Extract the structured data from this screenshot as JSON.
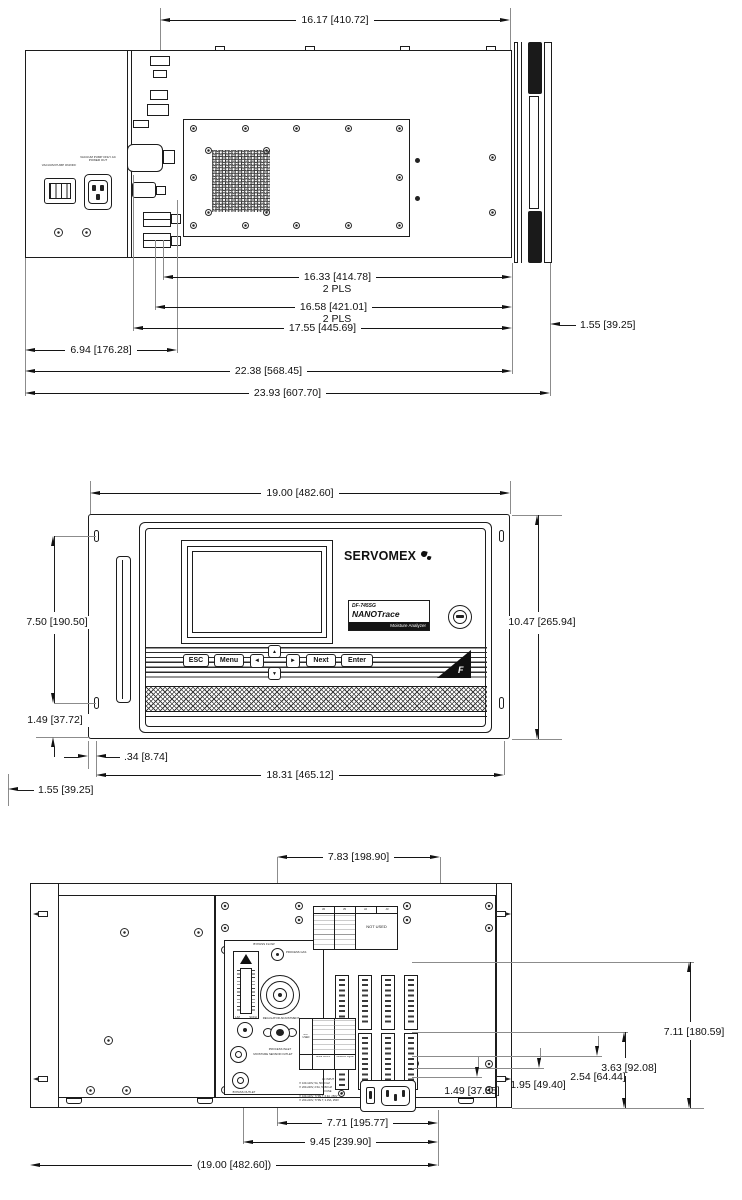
{
  "top_view": {
    "dims": {
      "overall": "16.17 [410.72]",
      "d1": "16.33 [414.78]",
      "d1_note": "2 PLS",
      "d2": "16.58 [421.01]",
      "d2_note": "2 PLS",
      "d3": "17.55 [445.69]",
      "d4": "6.94 [176.28]",
      "d5": "22.38 [568.45]",
      "d6": "23.93 [607.70]",
      "d7": "1.55 [39.25]"
    },
    "labels": {
      "switch": "VACUUM PUMP ON/OFF",
      "outlet": "VACUUM PUMP ONLY AC POWER OUT"
    }
  },
  "front_view": {
    "dims": {
      "width": "19.00 [482.60]",
      "slots": "7.50 [190.50]",
      "height": "10.47 [265.94]",
      "slot_edge": "1.49 [37.72]",
      "lip": ".34 [8.74]",
      "bezel": "18.31 [465.12]",
      "ear": "1.55 [39.25]"
    },
    "brand": "SERVOMEX",
    "label": {
      "model": "DF-745SG",
      "series": "NANOTrace",
      "type": "Moisture  Analyzer"
    },
    "buttons": {
      "esc": "ESC",
      "menu": "Menu",
      "left": "◄",
      "up": "▲",
      "down": "▼",
      "right": "►",
      "next": "Next",
      "enter": "Enter"
    },
    "cert": "F"
  },
  "rear_view": {
    "dims": {
      "top_offset": "7.83 [198.90]",
      "h1": "7.11 [180.59]",
      "h2": "3.63 [92.08]",
      "h3": "2.54 [64.44]",
      "h4": "1.95 [49.40]",
      "h5": "1.49 [37.85]",
      "w1": "7.71 [195.77]",
      "w2": "9.45 [239.90]",
      "w3": "(19.00 [482.60])"
    },
    "labels": {
      "bypass_flow": "BYPASS FLOW",
      "process_gas": "PROCESS GAS",
      "regulator": "REGULATOR ADJUSTMENT",
      "process_inlet": "PROCESS INLET",
      "sensor_outlet": "MOISTURE SENSOR OUTLET",
      "bypass_outlet": "BYPASS OUTLET",
      "flow_units_lm": "L/M",
      "flow_units_scfh": "SCFH",
      "not_used": "NOT USED",
      "serial": "Serial Comm",
      "signal": "Moisture Signal",
      "headers": [
        "J6",
        "J5",
        "J2",
        "J3"
      ],
      "strips": [
        "J7",
        "J10",
        "J5",
        "J4"
      ],
      "ac": [
        "AC INPUT",
        "☐ 100-120V, 5A, 50/60 HZ",
        "☐ 200-240V, 2.5A, 50/60 HZ",
        "FUSE",
        "☐ 100-120V, TYPE T, 6.3A, 250V",
        "☐ 200-240V, TYPE T, 3.15A, 250V"
      ]
    }
  }
}
